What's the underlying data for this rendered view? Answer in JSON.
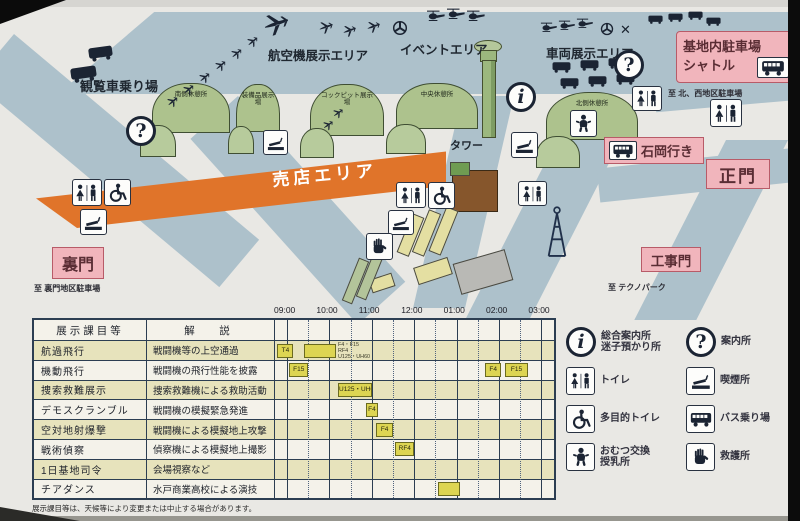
{
  "map": {
    "area_labels": {
      "ferris": "観覧車乗り場",
      "aircraft": "航空機展示エリア",
      "event": "イベントエリア",
      "vehicle": "車両展示エリア",
      "shop": "売店エリア",
      "tower": "タワー"
    },
    "buildings": {
      "south_rest": "南側休憩所",
      "equipment": "装備品展示場",
      "cockpit": "コックピット展示場",
      "central_rest": "中央休憩所",
      "north_rest": "北側休憩所"
    },
    "gates": {
      "main": "正門",
      "back": "裏門",
      "construction": "工事門"
    },
    "signs": {
      "shuttle_line1": "基地内駐車場",
      "shuttle_line2": "シャトル",
      "ishioka": "石岡行き",
      "to_north_west": "至 北、西地区駐車場",
      "to_back_gate": "至 裏門地区駐車場",
      "to_technopark": "至 テクノパーク"
    }
  },
  "schedule": {
    "col_subject": "展示課目等",
    "col_desc": "解　説",
    "times": [
      "09:00",
      "10:00",
      "11:00",
      "12:00",
      "01:00",
      "02:00",
      "03:00"
    ],
    "rows": [
      {
        "subject": "航過飛行",
        "desc": "戦闘機等の上空通過",
        "marks": [
          {
            "type": "label",
            "start": 8.82,
            "end": 9.2,
            "text": "T4"
          },
          {
            "type": "bar",
            "start": 9.45,
            "end": 10.2,
            "text": ""
          },
          {
            "type": "lines",
            "start": 10.25,
            "lines": [
              "F4・F15",
              "RF4",
              "U125・UH60"
            ]
          }
        ]
      },
      {
        "subject": "機動飛行",
        "desc": "戦闘機の飛行性能を披露",
        "marks": [
          {
            "type": "label",
            "start": 9.1,
            "end": 9.55,
            "text": "F15"
          },
          {
            "type": "label",
            "start": 13.72,
            "end": 14.1,
            "text": "F4"
          },
          {
            "type": "label",
            "start": 14.2,
            "end": 14.72,
            "text": "F15"
          }
        ]
      },
      {
        "subject": "捜索救難展示",
        "desc": "捜索救難機による救助活動",
        "marks": [
          {
            "type": "label",
            "start": 10.25,
            "end": 11.05,
            "text": "U125・UH60"
          }
        ]
      },
      {
        "subject": "デモスクランブル",
        "desc": "戦闘機の模擬緊急発進",
        "marks": [
          {
            "type": "label",
            "start": 10.9,
            "end": 11.2,
            "text": "F4"
          }
        ]
      },
      {
        "subject": "空対地射爆撃",
        "desc": "戦闘機による模擬地上攻撃",
        "marks": [
          {
            "type": "label",
            "start": 11.15,
            "end": 11.55,
            "text": "F4"
          }
        ]
      },
      {
        "subject": "戦術偵察",
        "desc": "偵察機による模擬地上撮影",
        "marks": [
          {
            "type": "label",
            "start": 11.6,
            "end": 12.05,
            "text": "RF4"
          }
        ]
      },
      {
        "subject": "1日基地司令",
        "desc": "会場視察など",
        "marks": []
      },
      {
        "subject": "チアダンス",
        "desc": "水戸商業高校による演技",
        "marks": [
          {
            "type": "bar",
            "start": 12.62,
            "end": 13.12,
            "text": ""
          }
        ]
      }
    ],
    "footnote": "展示課目等は、天候等により変更または中止する場合があります。"
  },
  "legend": {
    "items": [
      {
        "icon": "info-icon",
        "lines": [
          "総合案内所",
          "迷子預かり所"
        ]
      },
      {
        "icon": "question-icon",
        "lines": [
          "案内所"
        ]
      },
      {
        "icon": "toilet-icon",
        "lines": [
          "トイレ"
        ]
      },
      {
        "icon": "smoking-icon",
        "lines": [
          "喫煙所"
        ]
      },
      {
        "icon": "wheelchair-icon",
        "lines": [
          "多目的トイレ"
        ]
      },
      {
        "icon": "bus-icon",
        "lines": [
          "バス乗り場"
        ]
      },
      {
        "icon": "baby-icon",
        "lines": [
          "おむつ交換",
          "授乳所"
        ]
      },
      {
        "icon": "firstaid-icon",
        "lines": [
          "救護所"
        ]
      }
    ]
  },
  "colors": {
    "shop_band": "#e0742a",
    "building_green": "#adc28d",
    "runway_blue": "#adc1cb",
    "pink_sign": "#f1b5bc",
    "bar_yellow": "#ddd552",
    "row_cream": "#e7e3bc"
  }
}
